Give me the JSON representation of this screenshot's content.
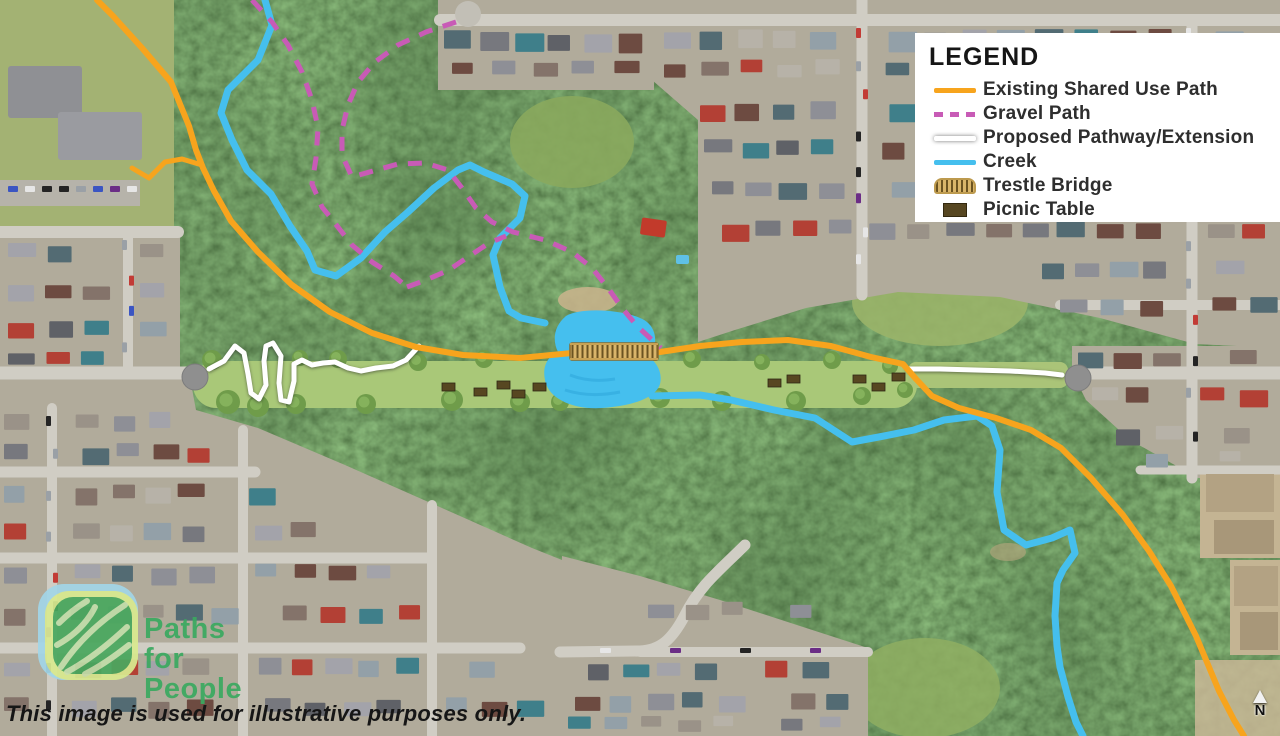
{
  "legend": {
    "title": "LEGEND",
    "items": [
      {
        "label": "Existing Shared Use Path",
        "swatch": "line",
        "color": "#F7A41D",
        "icon": "existing-shared-use-path-swatch"
      },
      {
        "label": "Gravel Path",
        "swatch": "dash",
        "color": "#C85BB6",
        "icon": "gravel-path-swatch"
      },
      {
        "label": "Proposed Pathway/Extension",
        "swatch": "white",
        "color": "#FFFFFF",
        "icon": "proposed-pathway-swatch"
      },
      {
        "label": "Creek",
        "swatch": "line",
        "color": "#45BFEE",
        "icon": "creek-swatch"
      },
      {
        "label": "Trestle Bridge",
        "swatch": "bridge",
        "color": "#D9B56A",
        "icon": "trestle-bridge-icon"
      },
      {
        "label": "Picnic Table",
        "swatch": "rect",
        "color": "#574721",
        "icon": "picnic-table-icon"
      }
    ]
  },
  "logo": {
    "line1": "Paths",
    "line2": "for",
    "line3": "People",
    "color": "#3BA960"
  },
  "disclaimer": "This image is used for illustrative purposes only.",
  "compass": {
    "label": "N"
  },
  "colors": {
    "existing_path": "#F7A41D",
    "gravel_path": "#C85BB6",
    "proposed_path": "#FFFFFF",
    "creek": "#45BFEE",
    "bridge_deck": "#D9B56A",
    "bridge_tie": "#6B5321",
    "picnic_table": "#574721"
  }
}
